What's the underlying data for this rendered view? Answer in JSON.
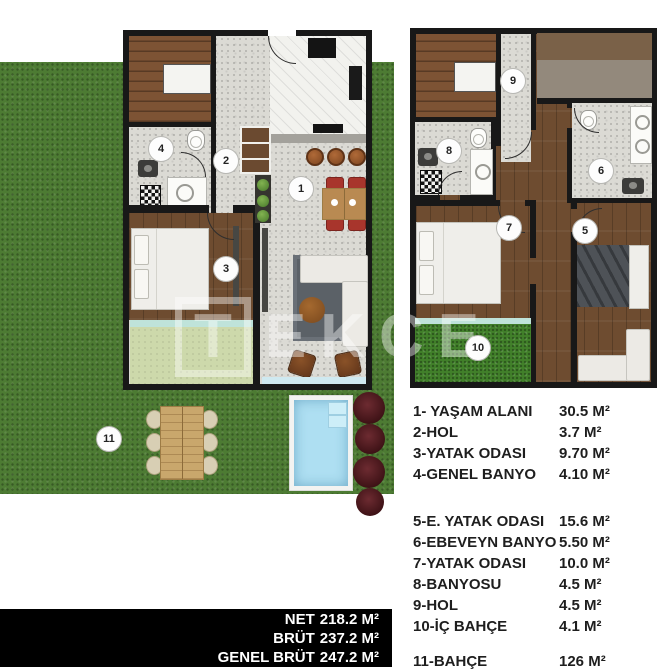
{
  "legend": {
    "items": [
      {
        "label": "1- YAŞAM ALANI",
        "value": "30.5 M²"
      },
      {
        "label": "2-HOL",
        "value": "3.7 M²"
      },
      {
        "label": "3-YATAK ODASI",
        "value": "9.70 M²"
      },
      {
        "label": "4-GENEL BANYO",
        "value": "4.10 M²"
      },
      {
        "label": "5-E. YATAK ODASI",
        "value": "15.6 M²"
      },
      {
        "label": "6-EBEVEYN BANYO",
        "value": "5.50 M²"
      },
      {
        "label": "7-YATAK ODASI",
        "value": "10.0 M²"
      },
      {
        "label": "8-BANYOSU",
        "value": "4.5 M²"
      },
      {
        "label": "9-HOL",
        "value": "4.5 M²"
      },
      {
        "label": "10-İÇ BAHÇE",
        "value": "4.1 M²"
      },
      {
        "label": "11-BAHÇE",
        "value": "126 M²"
      }
    ]
  },
  "totals": {
    "lines": [
      {
        "label": "NET",
        "value": "218.2 M²"
      },
      {
        "label": "BRÜT",
        "value": "237.2 M²"
      },
      {
        "label": "GENEL BRÜT",
        "value": "247.2 M²"
      }
    ]
  },
  "markers": [
    "1",
    "2",
    "3",
    "4",
    "5",
    "6",
    "7",
    "8",
    "9",
    "10",
    "11"
  ],
  "watermark": {
    "letters": [
      "T",
      "E",
      "K",
      "C",
      "E"
    ]
  },
  "colors": {
    "garden_grass": "#4d7b33",
    "inner_garden_grass": "#41802a",
    "terrace": "#cdd9ab",
    "pool_water": "#aedff2",
    "wall": "#181818",
    "wood_floor": "#6e4c30",
    "hall_floor": "#dbdad4",
    "dining_chair_red": "#a8352c",
    "bush_red": "#4e1d22",
    "totals_band": "#000000"
  }
}
